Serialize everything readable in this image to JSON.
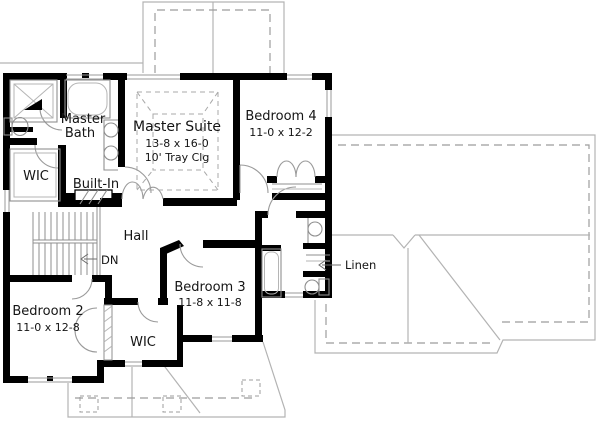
{
  "plan": {
    "rooms": {
      "master_suite": {
        "name": "Master Suite",
        "dims": "13-8 x 16-0",
        "note": "10' Tray Clg"
      },
      "master_bath": {
        "line1": "Master",
        "line2": "Bath"
      },
      "wic_master": {
        "name": "WIC"
      },
      "built_in": {
        "name": "Built-In"
      },
      "bedroom4": {
        "name": "Bedroom 4",
        "dims": "11-0 x 12-2"
      },
      "hall": {
        "name": "Hall"
      },
      "stairs": {
        "direction": "DN"
      },
      "bedroom2": {
        "name": "Bedroom 2",
        "dims": "11-0 x 12-8"
      },
      "bedroom3": {
        "name": "Bedroom 3",
        "dims": "11-8 x 11-8"
      },
      "wic_bedroom3": {
        "name": "WIC"
      },
      "linen": {
        "name": "Linen"
      }
    },
    "colors": {
      "wall": "#000000",
      "fixture": "#8f8f8f",
      "roof": "#b3b3b3",
      "background": "#ffffff"
    }
  }
}
